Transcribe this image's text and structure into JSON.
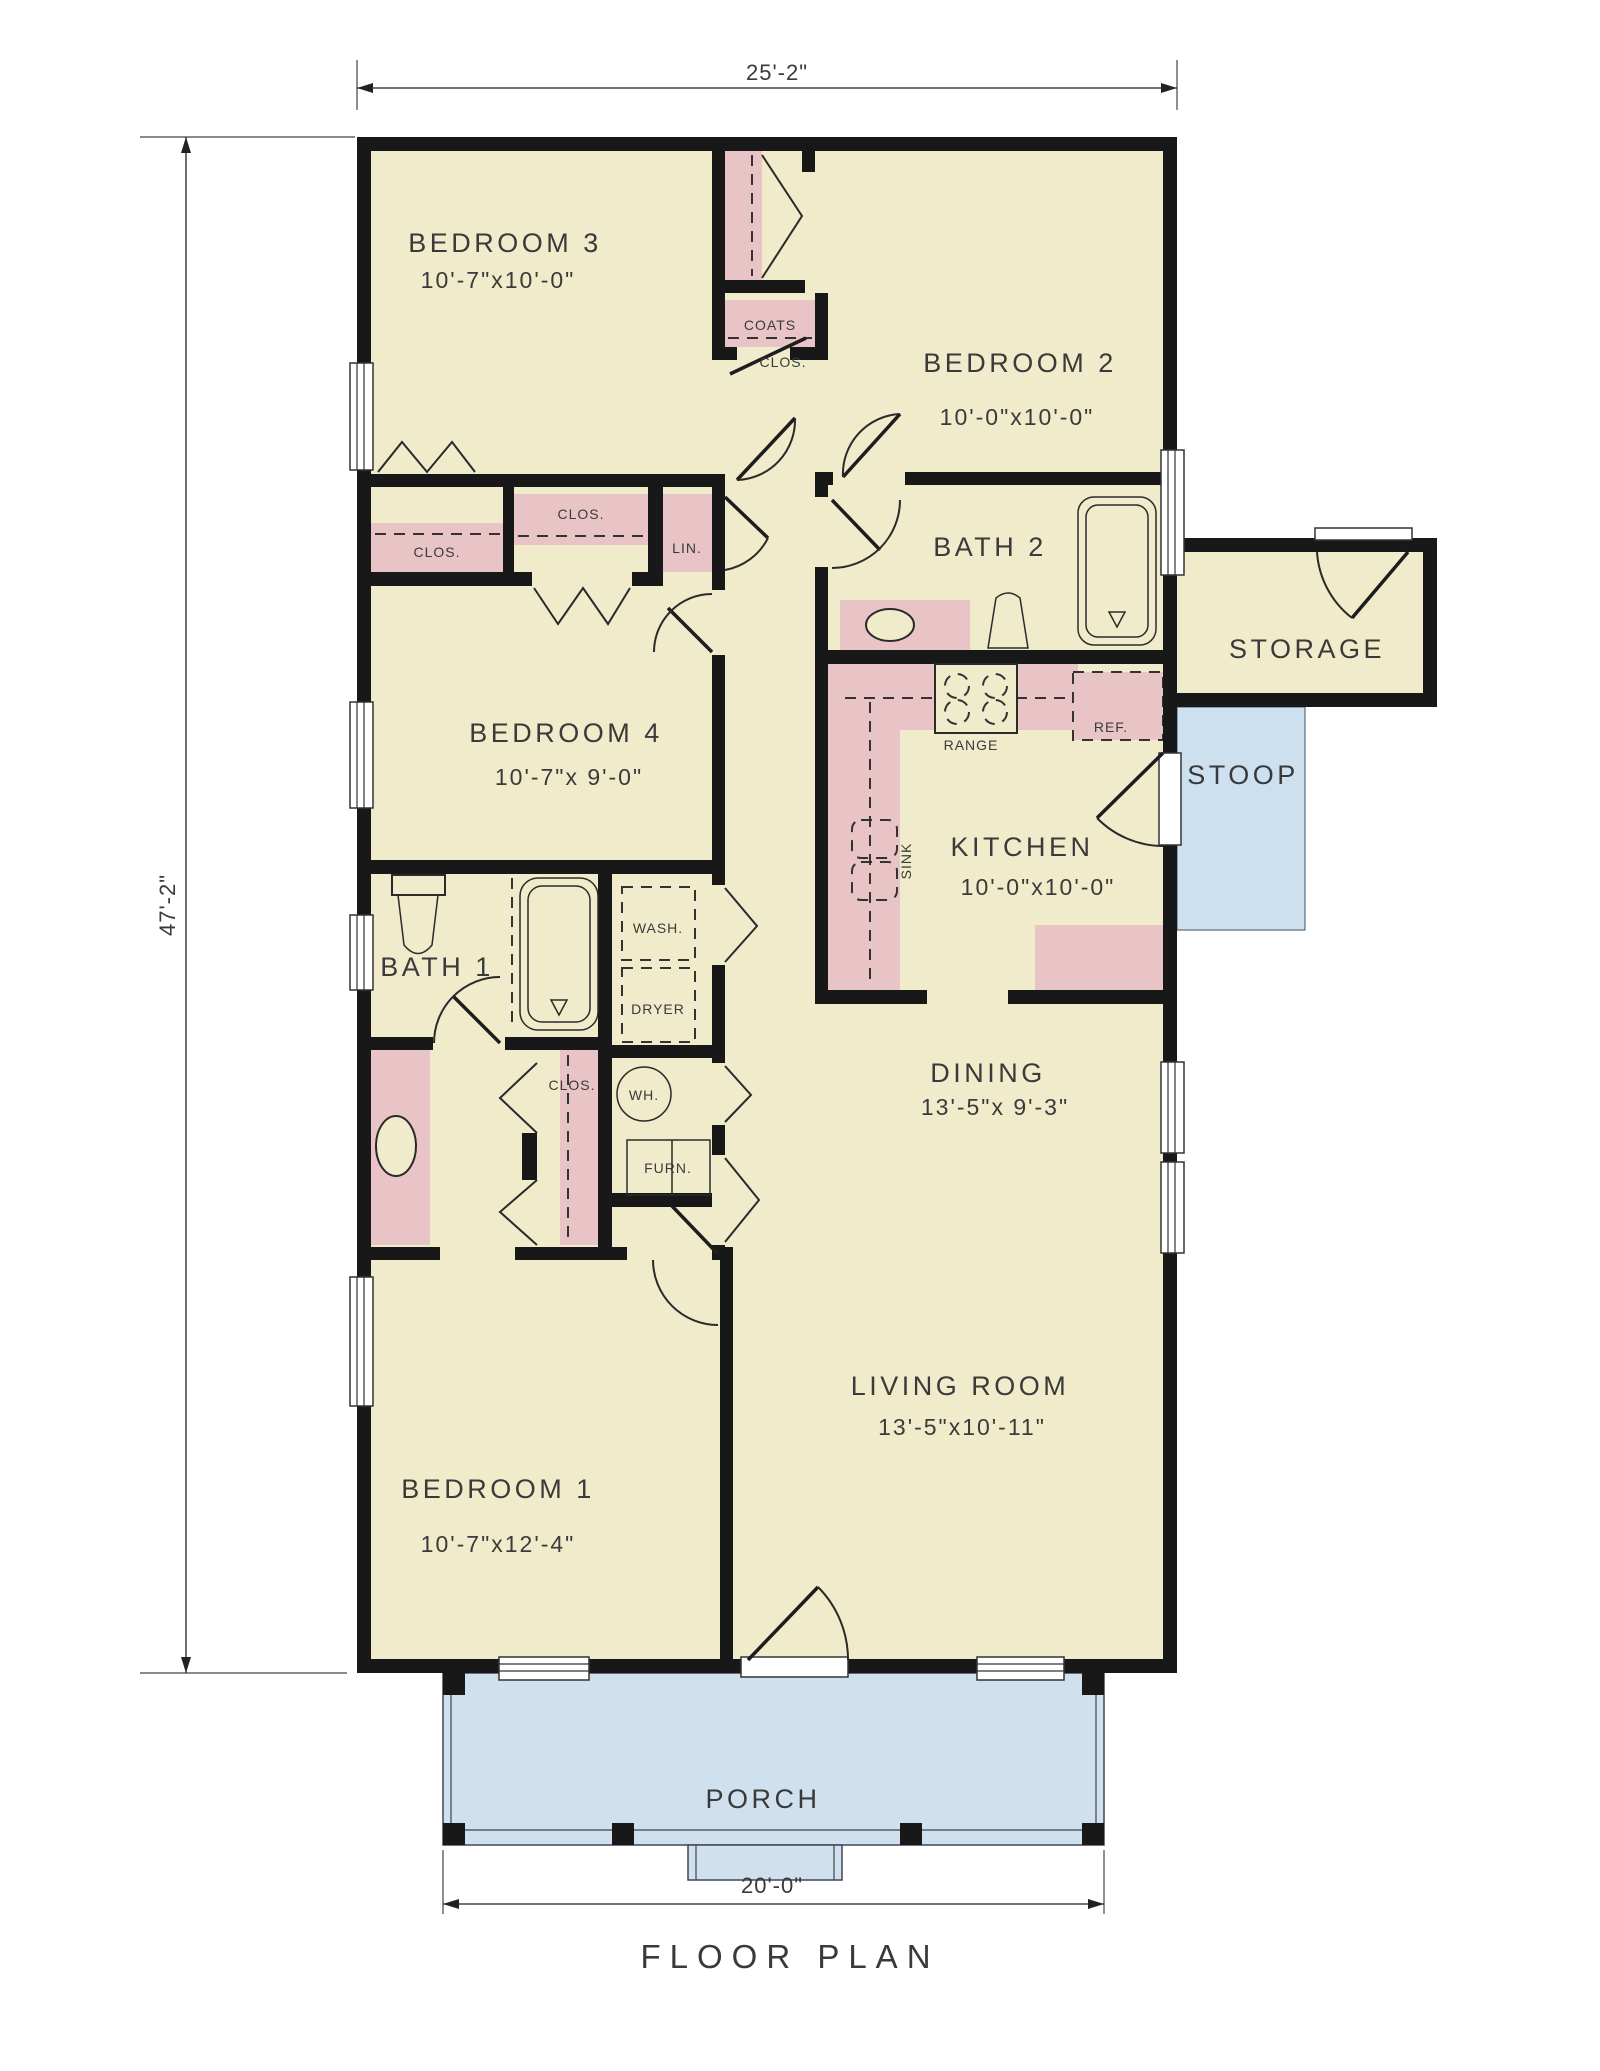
{
  "title": "FLOOR PLAN",
  "overall_dimensions": {
    "width_top": "25'-2\"",
    "depth_left": "47'-2\"",
    "porch_width_bottom": "20'-0\""
  },
  "rooms": {
    "bedroom3": {
      "name": "BEDROOM 3",
      "size": "10'-7\"x10'-0\""
    },
    "bedroom2": {
      "name": "BEDROOM 2",
      "size": "10'-0\"x10'-0\""
    },
    "bedroom4": {
      "name": "BEDROOM 4",
      "size": "10'-7\"x 9'-0\""
    },
    "bedroom1": {
      "name": "BEDROOM 1",
      "size": "10'-7\"x12'-4\""
    },
    "bath2": {
      "name": "BATH 2"
    },
    "bath1": {
      "name": "BATH 1"
    },
    "kitchen": {
      "name": "KITCHEN",
      "size": "10'-0\"x10'-0\""
    },
    "dining": {
      "name": "DINING",
      "size": "13'-5\"x 9'-3\""
    },
    "living": {
      "name": "LIVING ROOM",
      "size": "13'-5\"x10'-11\""
    },
    "storage": {
      "name": "STORAGE"
    },
    "stoop": {
      "name": "STOOP"
    },
    "porch": {
      "name": "PORCH"
    }
  },
  "closets": {
    "clos": "CLOS.",
    "coats": "COATS",
    "linen": "LIN."
  },
  "fixtures": {
    "range": "RANGE",
    "refrigerator": "REF.",
    "sink": "SINK",
    "washer": "WASH.",
    "dryer": "DRYER",
    "water_heater": "WH.",
    "furnace": "FURN."
  },
  "colors": {
    "floor": "#f0ebcb",
    "casework": "#e9c4c7",
    "porch": "#cfe1ee",
    "stoop": "#cde0f0",
    "wall": "#181818",
    "background": "#ffffff"
  }
}
